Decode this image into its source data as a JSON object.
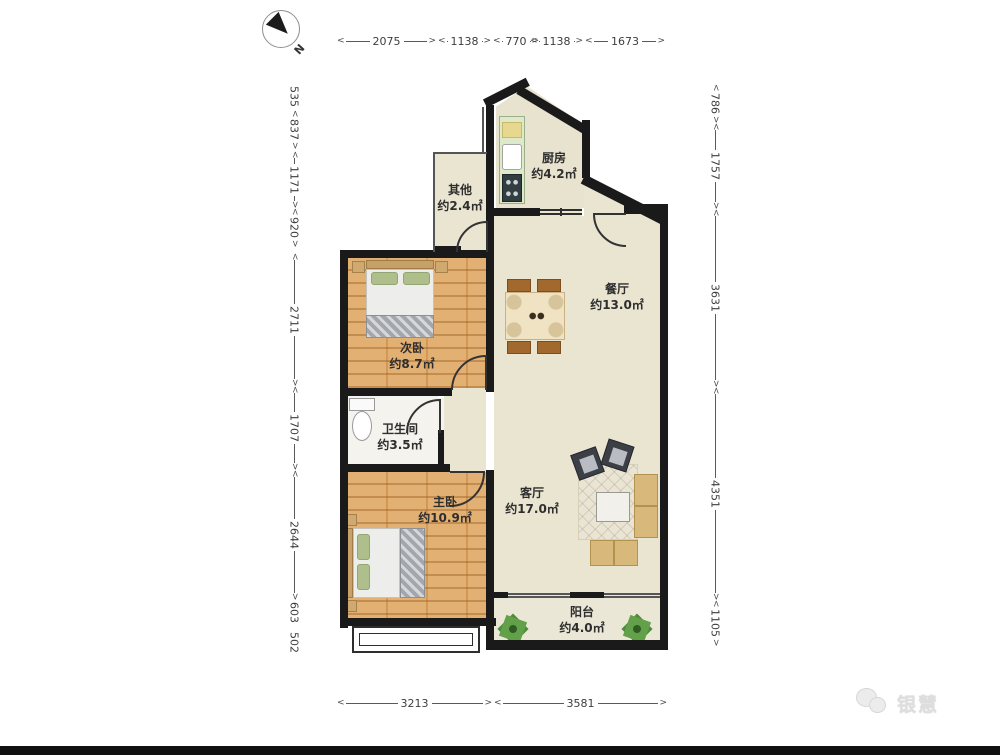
{
  "meta": {
    "compass_label": "N",
    "watermark": {
      "brand": "银慧",
      "icon": "chat-bubbles-icon"
    }
  },
  "rooms": {
    "kitchen": {
      "name": "厨房",
      "area": "约4.2㎡"
    },
    "other": {
      "name": "其他",
      "area": "约2.4㎡"
    },
    "dining": {
      "name": "餐厅",
      "area": "约13.0㎡"
    },
    "second_bedroom": {
      "name": "次卧",
      "area": "约8.7㎡"
    },
    "bathroom": {
      "name": "卫生间",
      "area": "约3.5㎡"
    },
    "master_bedroom": {
      "name": "主卧",
      "area": "约10.9㎡"
    },
    "living": {
      "name": "客厅",
      "area": "约17.0㎡"
    },
    "balcony": {
      "name": "阳台",
      "area": "约4.0㎡"
    }
  },
  "dims": {
    "top": [
      "2075",
      "1138",
      "770",
      "1138",
      "1673"
    ],
    "bottom": [
      "3213",
      "3581"
    ],
    "left": [
      "535",
      "837",
      "1171",
      "920",
      "2711",
      "1707",
      "2644",
      "603",
      "502"
    ],
    "right": [
      "786",
      "1757",
      "3631",
      "4351",
      "1105"
    ]
  },
  "colors": {
    "wall": "#1a1a1a",
    "floor_beige": "#e9e5d1",
    "floor_wood": "#e0a763",
    "floor_bath": "#f4f3ee",
    "plant_green": "#4e8c3b"
  }
}
